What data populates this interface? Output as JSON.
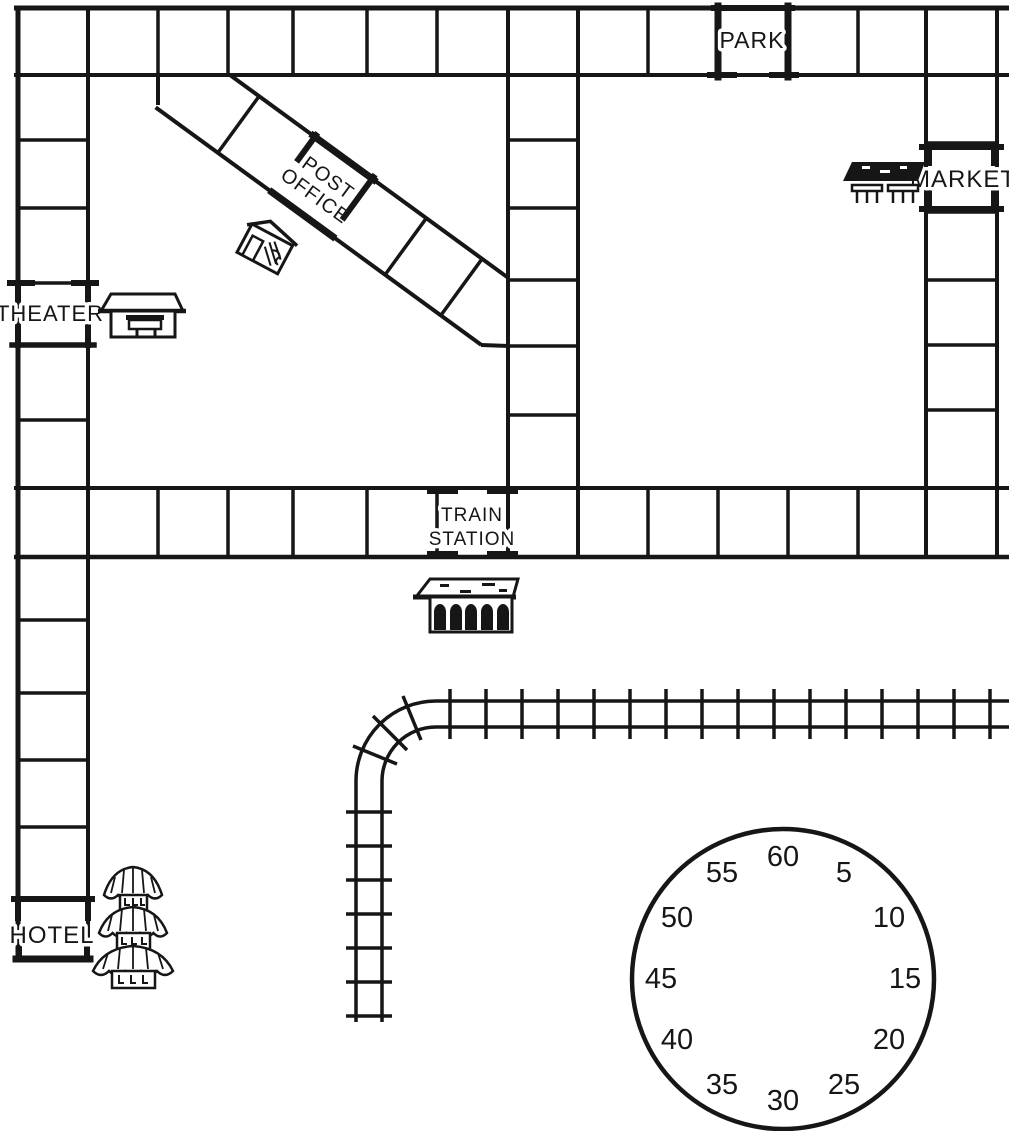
{
  "page": {
    "background": "#ffffff",
    "ink": "#161616"
  },
  "map": {
    "title": "town street-grid game map",
    "locations": {
      "park": {
        "label": "PARK"
      },
      "post_office": {
        "line1": "POST",
        "line2": "OFFICE"
      },
      "theater": {
        "label": "THEATER"
      },
      "market": {
        "label": "MARKET"
      },
      "train_station": {
        "line1": "TRAIN",
        "line2": "STATION"
      },
      "hotel": {
        "label": "HOTEL"
      }
    },
    "icons": [
      "theater-building-icon",
      "post-office-house-icon",
      "market-stall-icon",
      "train-station-building-icon",
      "pagoda-hotel-icon",
      "railroad-track"
    ],
    "dial": {
      "type": "minute-dial",
      "numbers": [
        "5",
        "10",
        "15",
        "20",
        "25",
        "30",
        "35",
        "40",
        "45",
        "50",
        "55",
        "60"
      ]
    }
  }
}
